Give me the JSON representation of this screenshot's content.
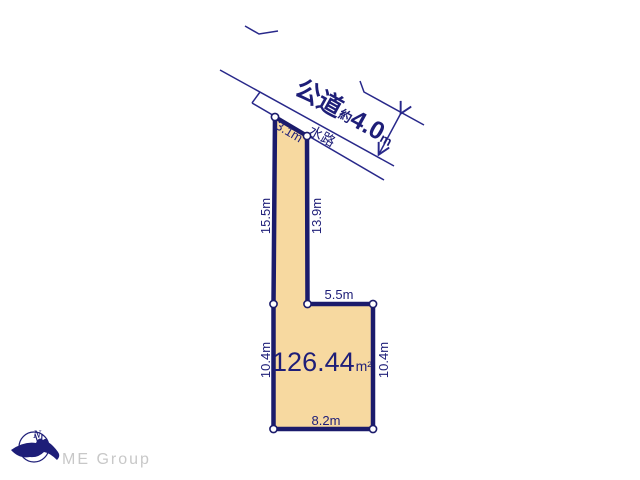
{
  "diagram": {
    "road": {
      "name": "公道",
      "approx": "約",
      "width_value": "4.0",
      "width_unit": "m",
      "waterway_label": "水路"
    },
    "plot": {
      "area_value": "126.44",
      "area_unit": "m²",
      "dimensions": {
        "top_edge": "3.1m",
        "left_upper": "15.5m",
        "strip_right": "13.9m",
        "notch": "5.5m",
        "left_lower": "10.4m",
        "right_lower": "10.4m",
        "bottom": "8.2m"
      }
    },
    "colors": {
      "outline_navy": "#1b1b6b",
      "line_navy": "#28288a",
      "plot_fill": "#f7d9a0",
      "text_navy": "#1e1e78",
      "brand_gray": "#c8c8c8",
      "background": "#ffffff"
    }
  },
  "footer": {
    "brand": "ME Group",
    "compass_north": "N"
  }
}
